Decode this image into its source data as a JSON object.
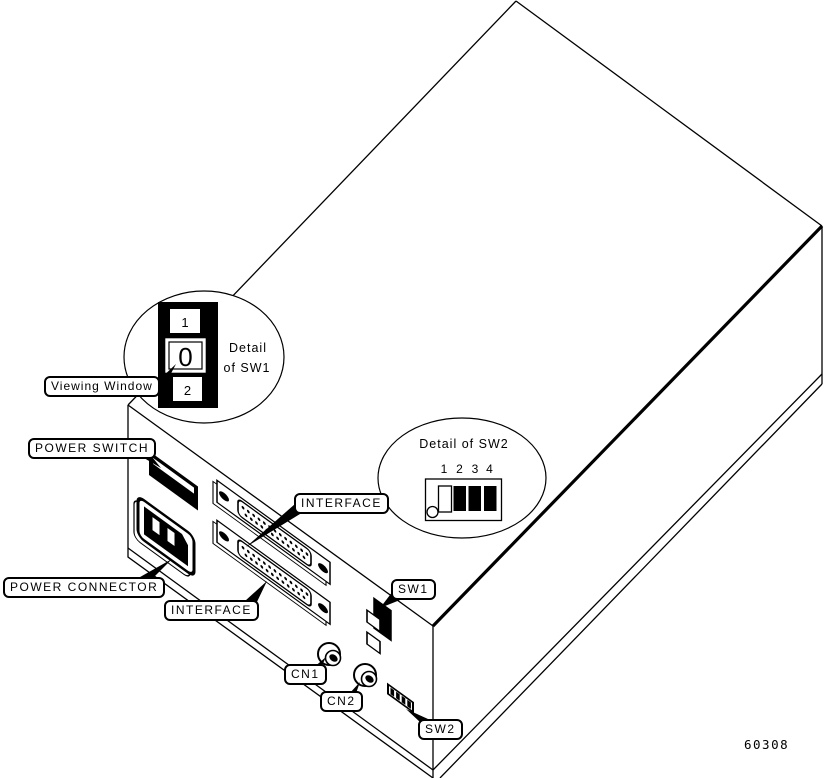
{
  "figure": {
    "number": "60308"
  },
  "colors": {
    "ink": "#000000",
    "paper": "#ffffff"
  },
  "callouts": {
    "viewing_window": "Viewing Window",
    "power_switch": "POWER SWITCH",
    "power_connector": "POWER CONNECTOR",
    "interface_top": "INTERFACE",
    "interface_bottom": "INTERFACE",
    "sw1": "SW1",
    "cn1": "CN1",
    "cn2": "CN2",
    "sw2": "SW2"
  },
  "sw1_detail": {
    "title_line1": "Detail",
    "title_line2": "of SW1",
    "top_position": "1",
    "window_value": "0",
    "bottom_position": "2"
  },
  "sw2_detail": {
    "title": "Detail of SW2",
    "positions": [
      "1",
      "2",
      "3",
      "4"
    ],
    "states": [
      "open",
      "closed",
      "closed",
      "closed"
    ]
  }
}
